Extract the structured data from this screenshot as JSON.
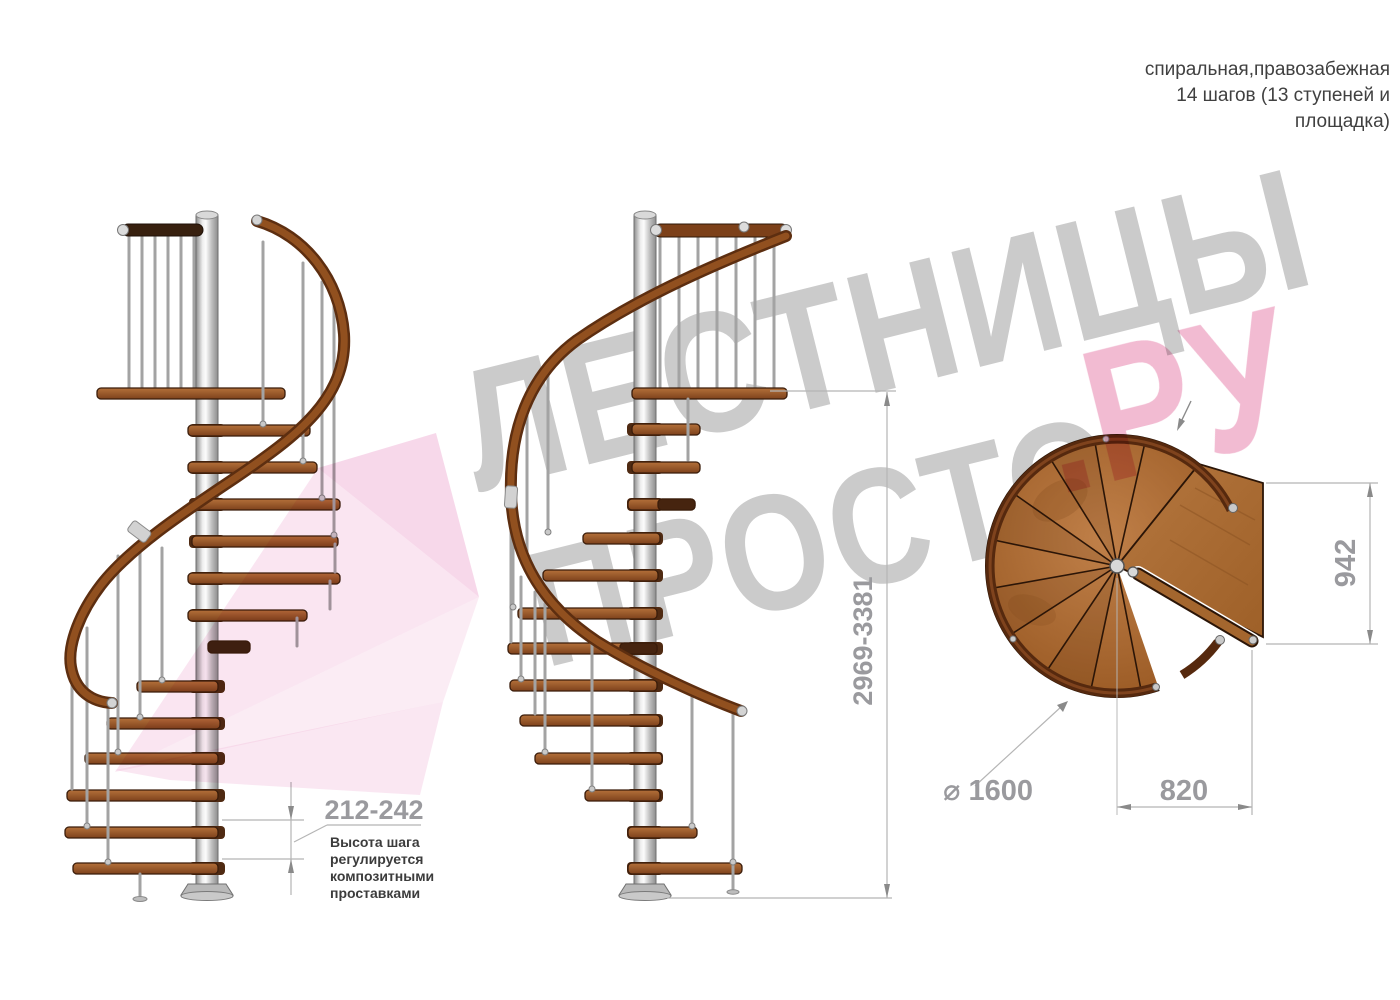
{
  "header": {
    "line1": "спиральная,правозабежная",
    "line2": "14 шагов (13 ступеней и",
    "line3": "площадка)"
  },
  "dimensions": {
    "step_height": "212-242",
    "step_note": [
      "Высота шага",
      "регулируется",
      "композитными",
      "проставками"
    ],
    "total_height": "2969-3381",
    "landing_width": "942",
    "entry_width": "820",
    "diameter": "⌀ 1600"
  },
  "watermark": {
    "line1": "ЛЕСТНИЦЫ",
    "line2": "ПРОСТО",
    "suffix": ".РУ",
    "gray": "#cbcbcb",
    "pink": "#f0b0ca"
  },
  "palette": {
    "wood": "#9a5a26",
    "rail": "#7c4019",
    "metal": "#c9c9c9",
    "dim": "#9a9a9e",
    "note": "#3c3c3c"
  }
}
